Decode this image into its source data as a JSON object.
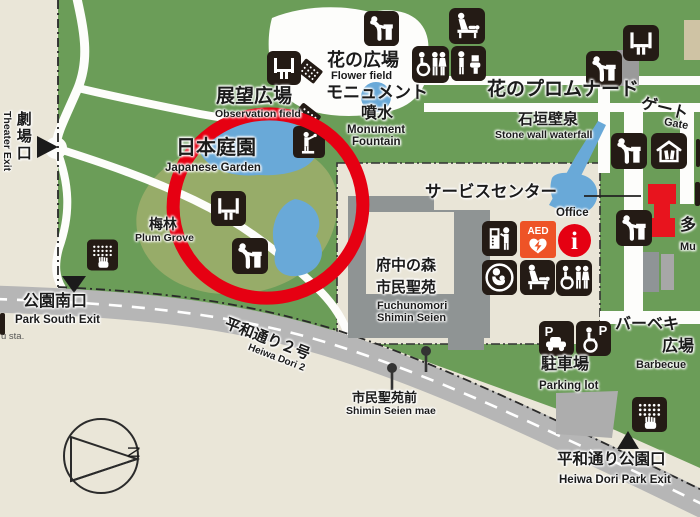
{
  "labels": {
    "theater_exit_jp": "劇場口",
    "theater_exit_en": "Theater Exit",
    "observation_jp": "展望広場",
    "observation_en": "Observation field",
    "flower_field_jp": "花の広場",
    "flower_field_en": "Flower field",
    "monument_jp": "モニュメント",
    "fountain_jp": "噴水",
    "monument_en": "Monument",
    "fountain_en": "Fountain",
    "promenade_jp": "花のプロムナード",
    "gate_jp": "ゲート",
    "gate_en": "Gate",
    "stonewall_jp": "石垣壁泉",
    "stonewall_en": "Stone wall waterfall",
    "garden_jp": "日本庭園",
    "garden_en": "Japanese Garden",
    "plum_jp": "梅林",
    "plum_en": "Plum Grove",
    "service_jp": "サービスセンター",
    "office_en": "Office",
    "seien_jp1": "府中の森",
    "seien_jp2": "市民聖苑",
    "seien_en1": "Fuchunomori",
    "seien_en2": "Shimin Seien",
    "south_exit_jp": "公園南口",
    "south_exit_en": "Park South Exit",
    "station_fragment": "u sta.",
    "road_jp": "平和通り２号",
    "road_en": "Heiwa Dori 2",
    "busstop_jp": "市民聖苑前",
    "busstop_en": "Shimin Seien mae",
    "parking_jp": "駐車場",
    "parking_en": "Parking lot",
    "bbq_jp1": "バーベキ",
    "bbq_jp2": "広場",
    "bbq_en": "Barbecue",
    "multi_jp": "多",
    "multi_en": "Mu",
    "heiwa_exit_jp": "平和通り公園口",
    "heiwa_exit_en": "Heiwa Dori Park Exit",
    "compass_n": "N",
    "aed": "AED",
    "info_i": "i",
    "p_car": "P",
    "p_acc": "P"
  },
  "icons": [
    "bench-icon",
    "pergola-icon",
    "statue-icon",
    "drinking-fountain-icon",
    "baby-care-icon",
    "accessible-toilet-icon",
    "toilet-icon",
    "storage-shed-icon",
    "tactile-map-icon",
    "vending-machine-icon",
    "aed-icon",
    "information-icon",
    "nursing-room-icon",
    "parking-car-icon",
    "accessible-parking-icon",
    "exit-triangle",
    "bus-stop-marker",
    "compass-rose",
    "highlight-circle-annotation"
  ],
  "colors": {
    "park_green": "#6b9d58",
    "light_green": "#97ac69",
    "background_beige": "#eae6d8",
    "water_blue": "#69a9d8",
    "road_gray": "#b6b6b6",
    "building_gray": "#8f9494",
    "icon_dark": "#241b15",
    "highlight_red": "#e60012",
    "aed_orange": "#ee5326",
    "info_red": "#e50012",
    "building_red": "#e8141e"
  }
}
